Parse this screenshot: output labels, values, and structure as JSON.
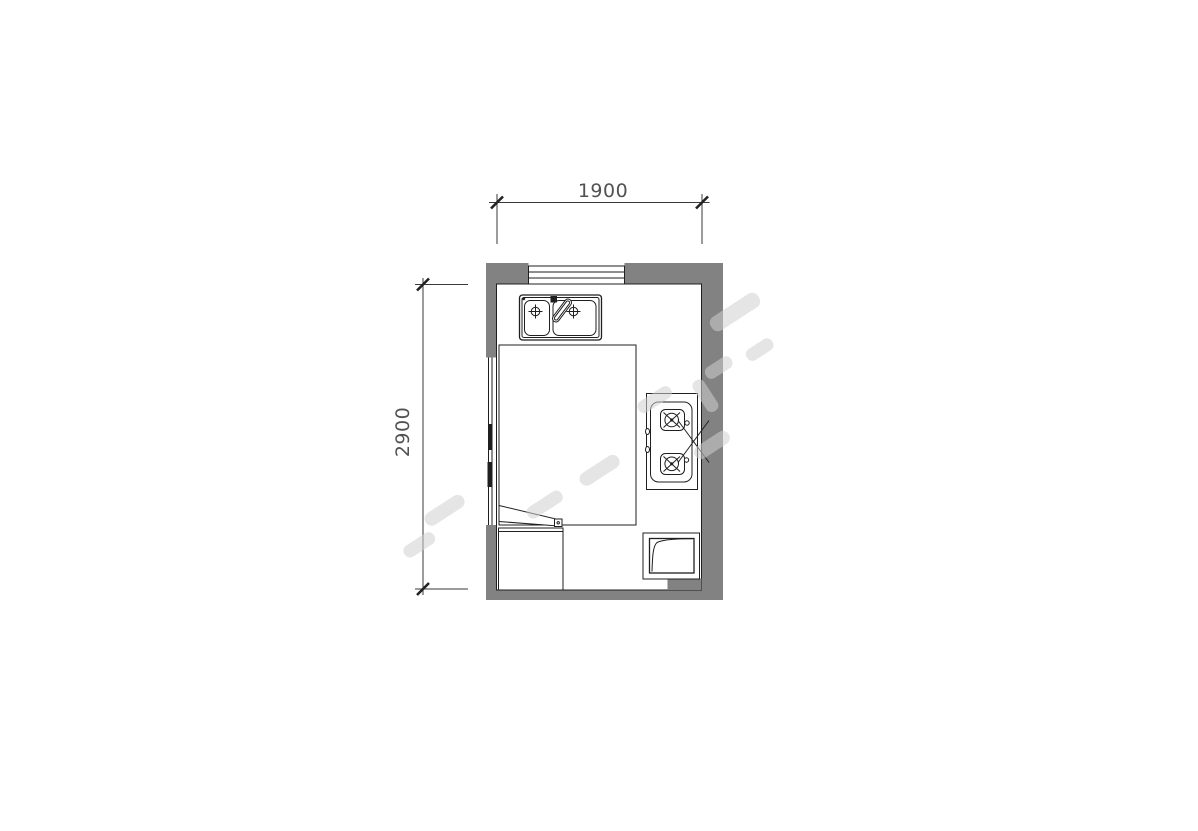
{
  "title": "kitchen floor plan drawing",
  "dimensions": {
    "width_mm": "1900",
    "height_mm": "2900"
  },
  "colors": {
    "background": "#ffffff",
    "wall": "#828282",
    "line": "#1f1f1f",
    "dim_text": "#3a3a3a",
    "watermark": "rgba(208,208,208,0.55)"
  },
  "fixtures": {
    "window": "window-icon",
    "door_opening": "door-opening-icon",
    "sink": "double-basin-sink-icon",
    "faucet": "faucet-icon",
    "counter": "counter-island",
    "stove": "gas-stove-two-burner-icon",
    "door_leaf": "door-leaf-icon",
    "base_cabinet": "base-cabinet",
    "appliance": "appliance-with-curve-icon"
  }
}
